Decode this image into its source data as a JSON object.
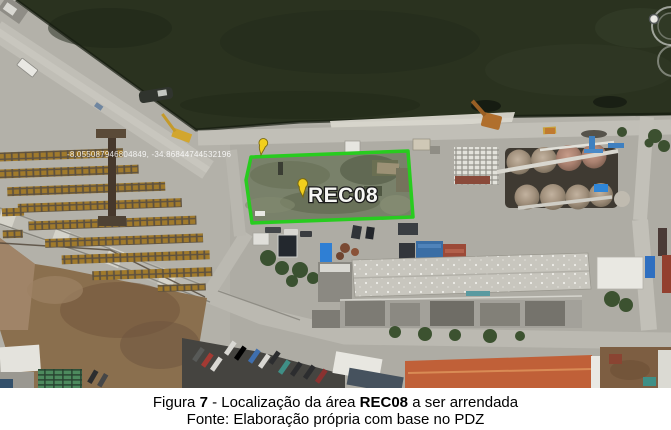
{
  "figure": {
    "caption": {
      "line1_prefix": "Figura ",
      "line1_number": "7",
      "line1_mid": " - Localização da área ",
      "line1_bold": "REC08",
      "line1_suffix": " a ser arrendada",
      "line2": "Fonte: Elaboração própria com base no PDZ"
    },
    "map": {
      "area_label": "REC08",
      "coordinates_label": "-8.055087946804849, -34.86844744532196",
      "colors": {
        "polygon_green": "#28cc1f",
        "pushpin_yellow": "#f2cf1d"
      }
    }
  }
}
